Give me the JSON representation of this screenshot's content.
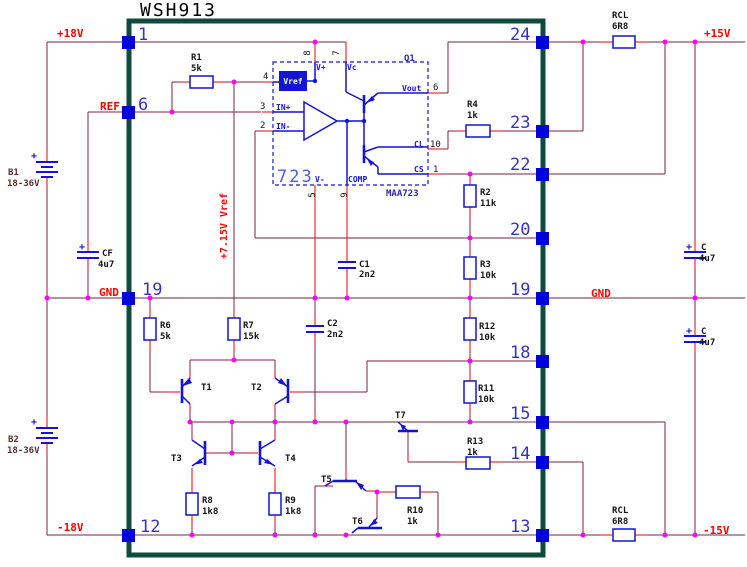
{
  "colors": {
    "wire": "#7b2346",
    "stub": "#f00000",
    "comp": "#1414d2",
    "dot": "#ff00ff",
    "pad": "#0000dd",
    "border": "#0e4a3e",
    "pinnum": "#3535bb",
    "label": "#141414",
    "netlabel": "#ff0000",
    "batlabel": "#5a2d2d",
    "icbig": "#4d5fe0",
    "icpart": "#2a2ab0"
  },
  "title": "WSH913",
  "nets": {
    "vpos": "+18V",
    "ref": "REF",
    "gnd_l": "GND",
    "vneg": "-18V",
    "vref_rail": "+7.15V Vref",
    "p15": "+15V",
    "gnd_r": "GND",
    "m15": "-15V"
  },
  "pins": {
    "left": [
      "1",
      "6",
      "19",
      "12"
    ],
    "right": [
      "24",
      "23",
      "22",
      "20",
      "19",
      "18",
      "15",
      "14",
      "13"
    ]
  },
  "plus": "+",
  "parts": {
    "r1": {
      "name": "R1",
      "value": "5k"
    },
    "r2": {
      "name": "R2",
      "value": "11k"
    },
    "r3": {
      "name": "R3",
      "value": "10k"
    },
    "r4": {
      "name": "R4",
      "value": "1k"
    },
    "r6": {
      "name": "R6",
      "value": "5k"
    },
    "r7": {
      "name": "R7",
      "value": "15k"
    },
    "r8": {
      "name": "R8",
      "value": "1k8"
    },
    "r9": {
      "name": "R9",
      "value": "1k8"
    },
    "r10": {
      "name": "R10",
      "value": "1k"
    },
    "r11": {
      "name": "R11",
      "value": "10k"
    },
    "r12": {
      "name": "R12",
      "value": "10k"
    },
    "r13": {
      "name": "R13",
      "value": "1k"
    },
    "rcl_top": {
      "name": "RCL",
      "value": "6R8"
    },
    "rcl_bot": {
      "name": "RCL",
      "value": "6R8"
    },
    "cf": {
      "name": "CF",
      "value": "4u7"
    },
    "c1": {
      "name": "C1",
      "value": "2n2"
    },
    "c2": {
      "name": "C2",
      "value": "2n2"
    },
    "c_top": {
      "name": "C",
      "value": "4u7"
    },
    "c_bot": {
      "name": "C",
      "value": "4u7"
    },
    "b1": {
      "name": "B1",
      "value": "18-36V"
    },
    "b2": {
      "name": "B2",
      "value": "18-36V"
    },
    "t1": "T1",
    "t2": "T2",
    "t3": "T3",
    "t4": "T4",
    "t5": "T5",
    "t6": "T6",
    "t7": "T7",
    "q1": "Q1"
  },
  "ic": {
    "big": "723",
    "part": "MAA723",
    "labels": {
      "vref": "Vref",
      "vplus": "V+",
      "vc": "Vc",
      "inp": "IN+",
      "inn": "IN-",
      "vout": "Vout",
      "cl": "CL",
      "cs": "CS",
      "comp": "COMP",
      "vminus": "V-"
    },
    "nums": {
      "n8": "8",
      "n7": "7",
      "n4": "4",
      "n3": "3",
      "n2": "2",
      "n6": "6",
      "n10": "10",
      "n1": "1",
      "n5": "5",
      "n9": "9"
    }
  }
}
